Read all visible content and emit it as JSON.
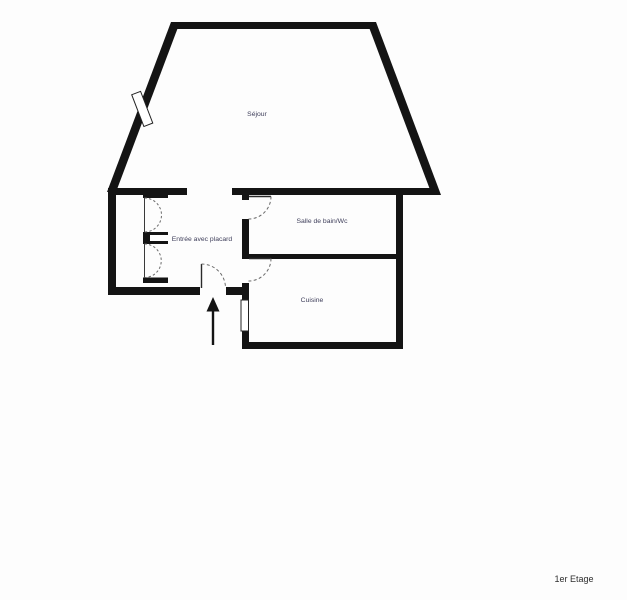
{
  "floorplan": {
    "title": "1er Etage",
    "rooms": [
      {
        "name": "sejour",
        "label": "Séjour"
      },
      {
        "name": "entree",
        "label": "Entrée avec placard"
      },
      {
        "name": "salle-de-bain",
        "label": "Salle de bain/Wc"
      },
      {
        "name": "cuisine",
        "label": "Cuisine"
      }
    ],
    "features": {
      "windows": [
        "sejour-window",
        "cuisine-window"
      ],
      "doors": [
        "entrance-door",
        "salle-de-bain-door",
        "cuisine-door"
      ],
      "closet": "placard-double-doors",
      "entrance_marker": "entrance-arrow"
    },
    "colors": {
      "wall": "#141414",
      "background": "#fdfdfd",
      "room_label": "#3e3e5a",
      "floor_label": "#2e2e2e"
    }
  }
}
